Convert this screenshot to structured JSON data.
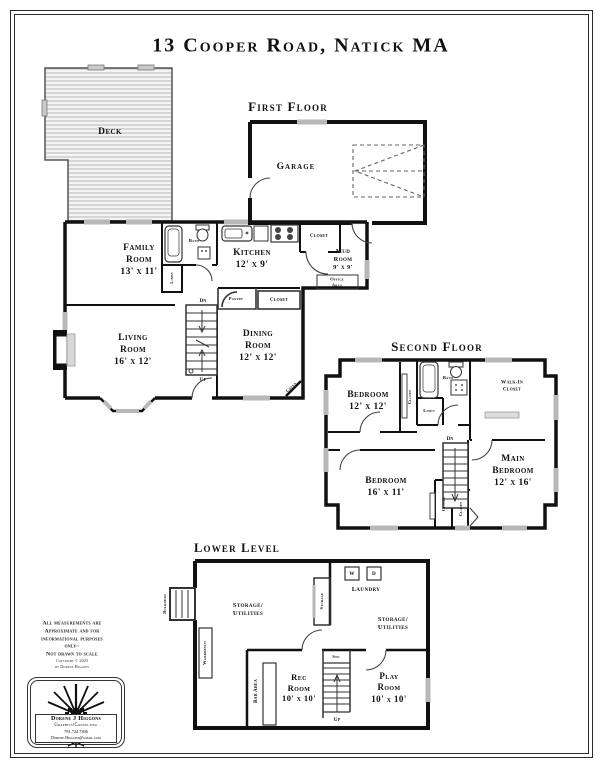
{
  "title": "13 Cooper Road, Natick MA",
  "floors": {
    "first": {
      "heading": "First Floor",
      "deck": "Deck",
      "garage": "Garage",
      "closet_top": "Closet",
      "family_room": "Family\nRoom\n13' x 11'",
      "bath": "Bath",
      "linen": "Linen",
      "kitchen": "Kitchen\n12' x 9'",
      "mud_room": "Mud\nRoom\n9' x 9'",
      "office_area": "Office\nArea",
      "pantry": "Pantry",
      "closet_bottom": "Closet",
      "living_room": "Living\nRoom\n16' x 12'",
      "dining_room": "Dining\nRoom\n12' x 12'",
      "china": "China",
      "dn": "Dn",
      "up": "Up"
    },
    "second": {
      "heading": "Second Floor",
      "bedroom_1": "Bedroom\n12' x 12'",
      "closet_1": "Closet",
      "bath": "Bath",
      "linen": "Linen",
      "walk_in_closet": "Walk-In\nCloset",
      "bedroom_2": "Bedroom\n16' x 11'",
      "main_bedroom": "Main\nBedroom\n12' x 16'",
      "closet_2": "Closet",
      "closet_3": "Closet",
      "dn": "Dn"
    },
    "lower": {
      "heading": "Lower Level",
      "bulkhead": "Bulkhead",
      "storage_utilities_left": "Storage/\nUtilities",
      "storage": "Storage",
      "washer": "W",
      "dryer": "D",
      "laundry": "Laundry",
      "storage_utilities_right": "Storage/\nUtilities",
      "workbench": "Workbench",
      "sto": "Sto",
      "rec_room": "Rec\nRoom\n10' x 10'",
      "bar_area": "Bar Area",
      "play_room": "Play\nRoom\n10' x 10'",
      "up": "Up"
    }
  },
  "footer": {
    "disclaimer": "All measurements are\nApproximate and for\ninformational purposes\nonly~\nNot drawn to scale",
    "copyright": "Copyright © 2025\nby Dorene Higgons",
    "logo": {
      "name": "Dorene J Higgons",
      "tagline": "Graphics/Consulting",
      "phone": "781.724.7306",
      "email": "Dorene.Higgons@gmail.com"
    }
  },
  "colors": {
    "ink": "#111111",
    "window_gray": "#b8b8b8",
    "deck_hatch": "#bfbfbf"
  }
}
